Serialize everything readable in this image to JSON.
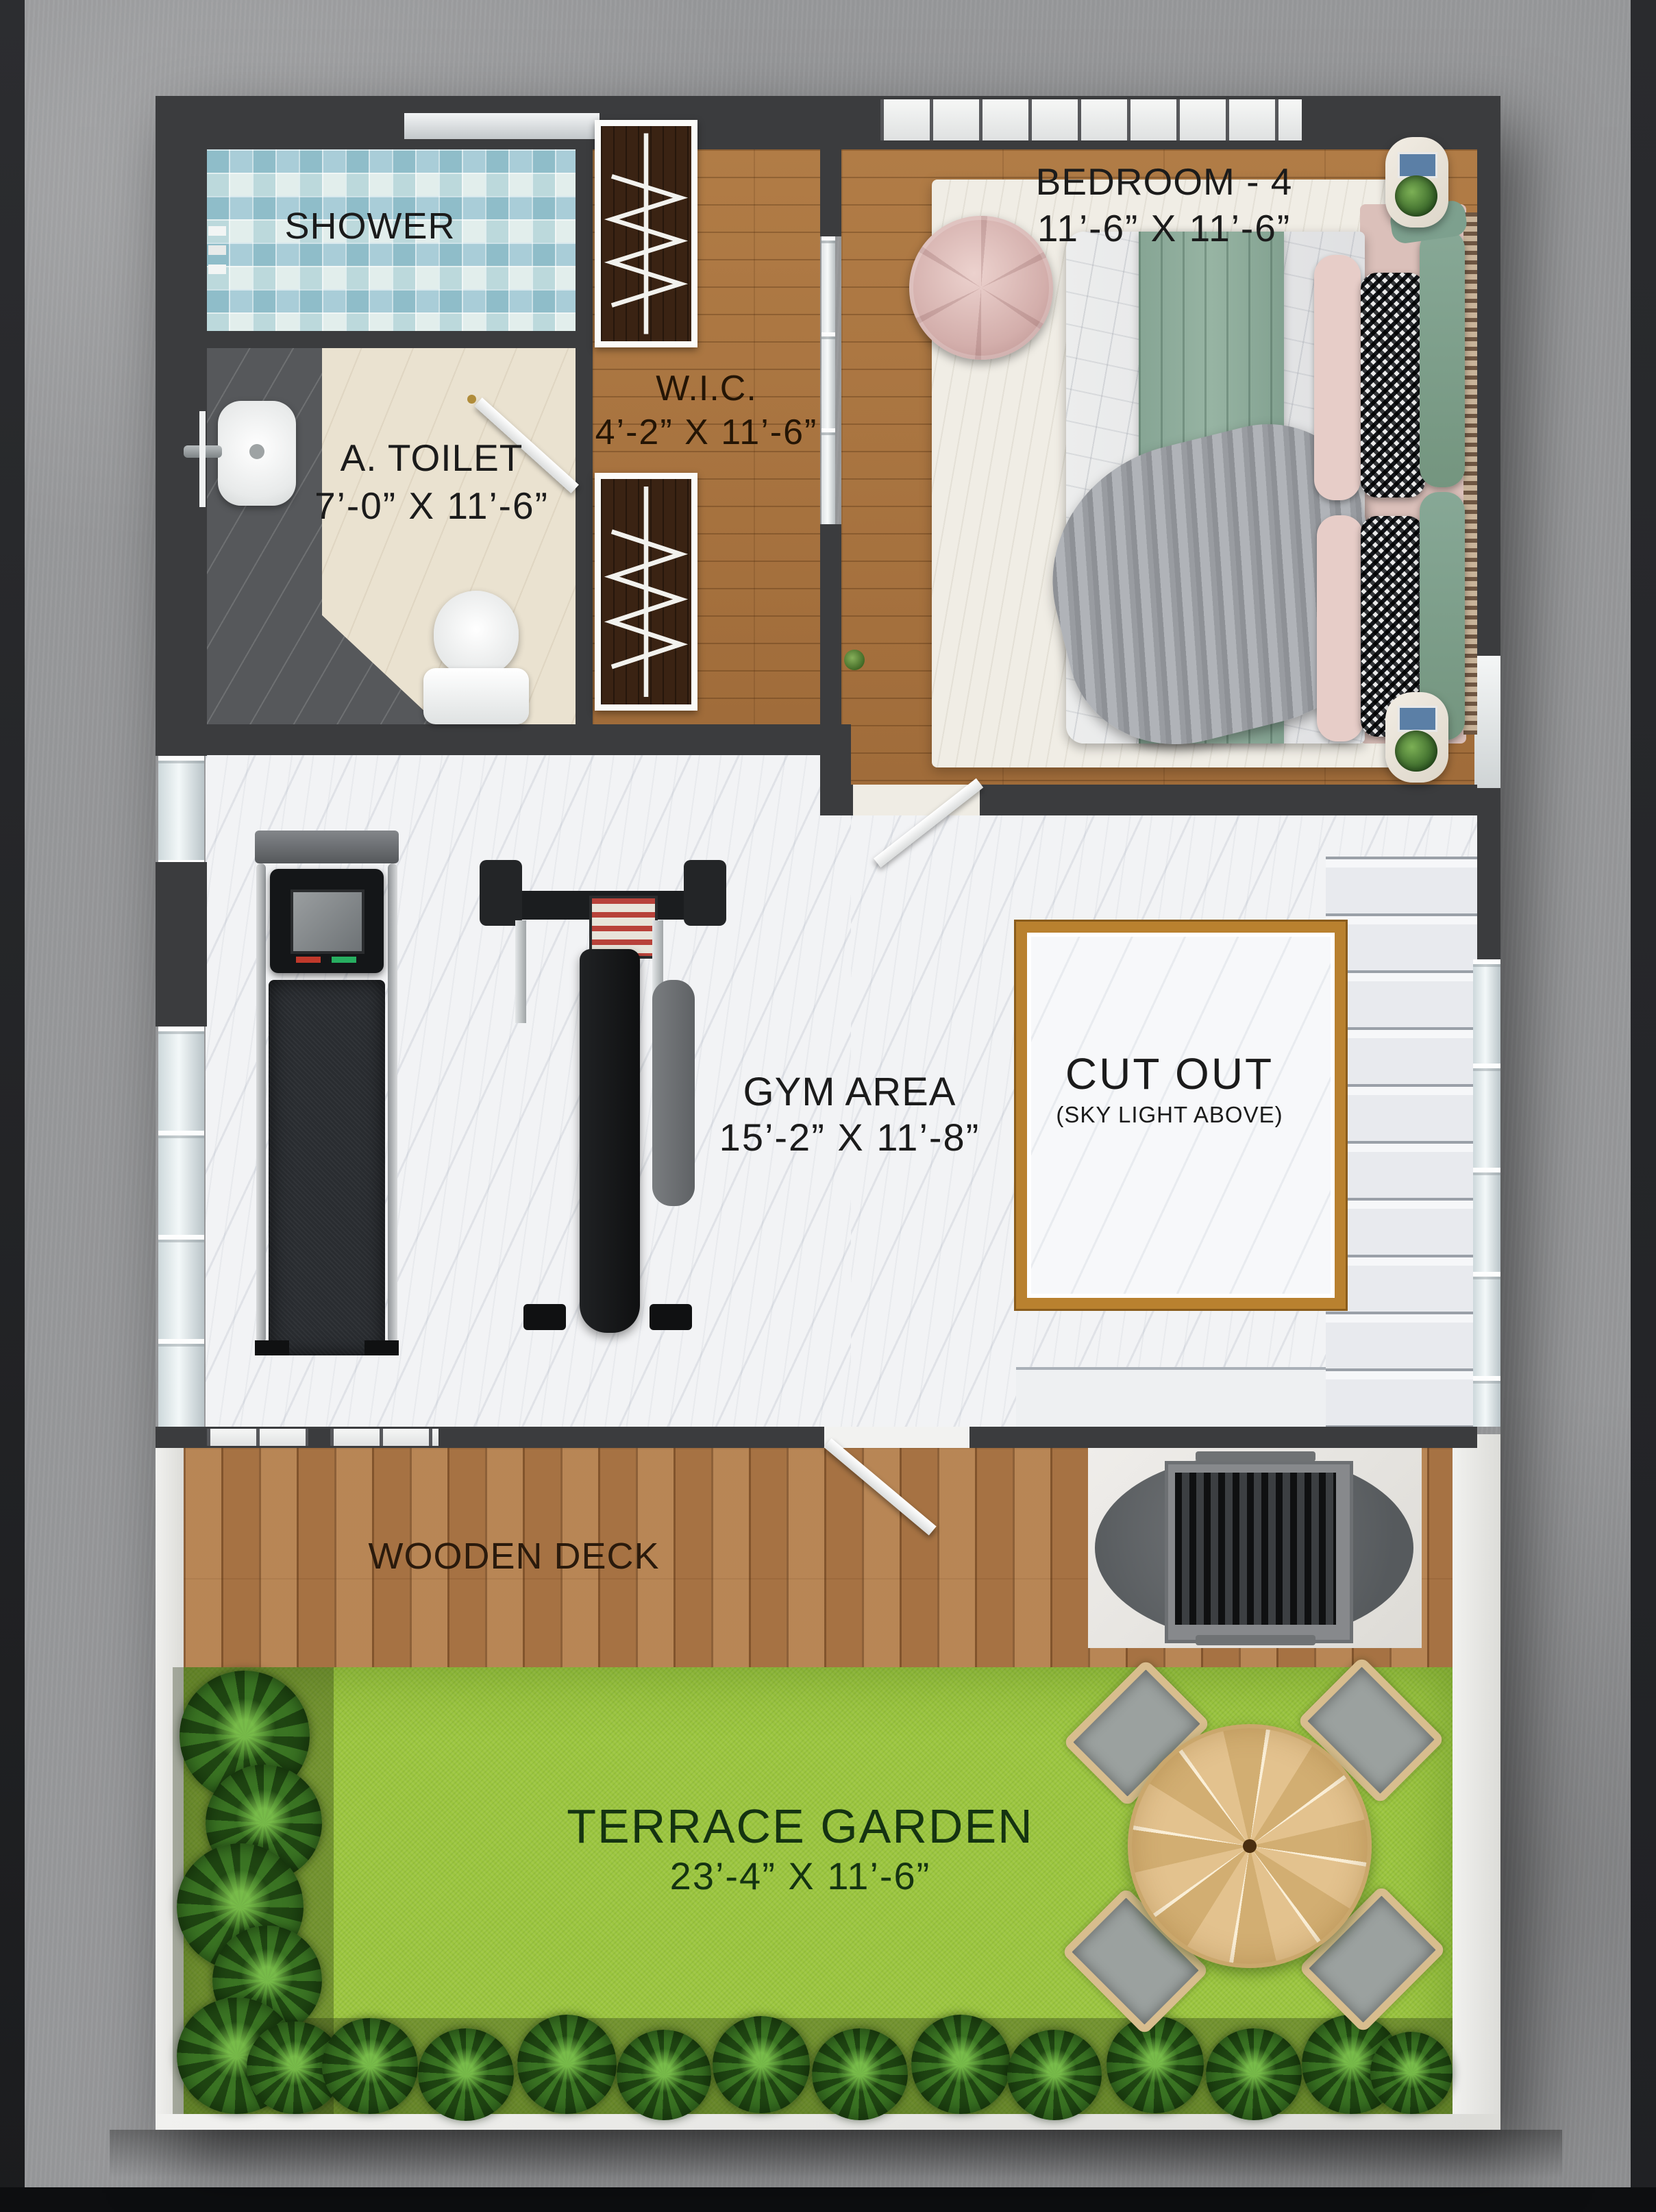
{
  "rooms": {
    "shower": {
      "name": "SHOWER"
    },
    "toilet": {
      "name": "A. TOILET",
      "dims": "7’-0” X 11’-6”"
    },
    "wic": {
      "name": "W.I.C.",
      "dims": "4’-2” X 11’-6”"
    },
    "bedroom4": {
      "name": "BEDROOM - 4",
      "dims": "11’-6” X 11’-6”"
    },
    "gym": {
      "name": "GYM AREA",
      "dims": "15’-2” X 11’-8”"
    },
    "cutout": {
      "name": "CUT OUT",
      "note": "(SKY LIGHT ABOVE)"
    },
    "deck": {
      "name": "WOODEN DECK"
    },
    "garden": {
      "name": "TERRACE GARDEN",
      "dims": "23’-4” X 11’-6”"
    }
  },
  "palette": {
    "wall": "#3b3c3e",
    "marble": "#f2f3f5",
    "wood": "#a9763f",
    "deck_wood": "#b07c4b",
    "grass": "#9cc63f",
    "gold_frame": "#b9812f",
    "shower_tile": "#bcd9dc",
    "concrete": "#98999b"
  }
}
